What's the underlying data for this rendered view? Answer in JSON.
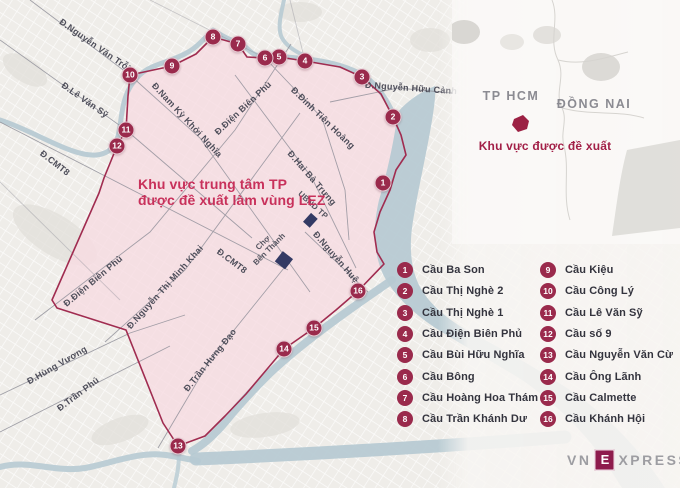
{
  "title": {
    "line1": "Khu vực trung tâm TP",
    "line2": "được đề xuất làm vùng LEZ"
  },
  "map": {
    "street_labels": {
      "nguyen_van_troi": "Đ.Nguyễn Văn Trỗi",
      "le_van_sy": "Đ.Lê Văn Sỹ",
      "cmt8_left": "Đ.CMT8",
      "nam_ky_khoi_nghia": "Đ.Nam Kỳ Khởi Nghĩa",
      "dien_bien_phu_top": "Đ.Điện Biên Phủ",
      "dinh_tien_hoang": "Đ.Đinh Tiên Hoàng",
      "nguyen_huu_canh": "Đ.Nguyễn Hữu Cảnh",
      "hai_ba_trung": "Đ.Hai Bà Trưng",
      "nguyen_hue": "Đ.Nguyễn Huệ",
      "cmt8_center": "Đ.CMT8",
      "dien_bien_phu_bottom": "Đ.Điện Biên Phủ",
      "nguyen_thi_minh_khai": "Đ.Nguyễn Thị Minh Khai",
      "tran_hung_dao": "Đ.Trần Hưng Đạo",
      "hung_vuong": "Đ.Hùng Vương",
      "tran_phu": "Đ.Trần Phú"
    },
    "landmarks": {
      "ubnd": "UBND TP",
      "cho": "Chợ",
      "ben_thanh": "Bến Thành"
    },
    "markers": [
      {
        "n": "1",
        "x": 383,
        "y": 183
      },
      {
        "n": "2",
        "x": 393,
        "y": 117
      },
      {
        "n": "3",
        "x": 362,
        "y": 77
      },
      {
        "n": "4",
        "x": 305,
        "y": 61
      },
      {
        "n": "5",
        "x": 279,
        "y": 57
      },
      {
        "n": "6",
        "x": 265,
        "y": 58
      },
      {
        "n": "7",
        "x": 238,
        "y": 44
      },
      {
        "n": "8",
        "x": 213,
        "y": 37
      },
      {
        "n": "9",
        "x": 172,
        "y": 66
      },
      {
        "n": "10",
        "x": 130,
        "y": 75
      },
      {
        "n": "11",
        "x": 126,
        "y": 130
      },
      {
        "n": "12",
        "x": 117,
        "y": 146
      },
      {
        "n": "13",
        "x": 178,
        "y": 446
      },
      {
        "n": "14",
        "x": 284,
        "y": 349
      },
      {
        "n": "15",
        "x": 314,
        "y": 328
      },
      {
        "n": "16",
        "x": 358,
        "y": 291
      }
    ]
  },
  "inset": {
    "region_left": "TP HCM",
    "region_right": "ĐỒNG NAI",
    "caption": "Khu vực được đề xuất"
  },
  "legend": {
    "items": [
      {
        "n": "1",
        "label": "Cầu Ba Son"
      },
      {
        "n": "2",
        "label": "Cầu Thị Nghè 2"
      },
      {
        "n": "3",
        "label": "Cầu Thị Nghè 1"
      },
      {
        "n": "4",
        "label": "Cầu Điện Biên Phủ"
      },
      {
        "n": "5",
        "label": "Cầu Bùi Hữu Nghĩa"
      },
      {
        "n": "6",
        "label": "Cầu Bông"
      },
      {
        "n": "7",
        "label": "Cầu Hoàng Hoa Thám"
      },
      {
        "n": "8",
        "label": "Cầu Trần Khánh Dư"
      },
      {
        "n": "9",
        "label": "Cầu Kiệu"
      },
      {
        "n": "10",
        "label": "Cầu Công Lý"
      },
      {
        "n": "11",
        "label": "Cầu Lê Văn Sỹ"
      },
      {
        "n": "12",
        "label": "Cầu số 9"
      },
      {
        "n": "13",
        "label": "Cầu Nguyễn Văn Cừ"
      },
      {
        "n": "14",
        "label": "Cầu Ông Lãnh"
      },
      {
        "n": "15",
        "label": "Cầu Calmette"
      },
      {
        "n": "16",
        "label": "Cầu Khánh Hội"
      }
    ]
  },
  "logo": {
    "pre": "VN",
    "mid": "E",
    "post": "XPRESS"
  },
  "colors": {
    "accent": "#9a2a4c",
    "title": "#c8315b",
    "zone_fill": "#f7dce2",
    "zone_border": "#a02c50",
    "water": "#b7cad3",
    "landmark": "#333a64"
  }
}
